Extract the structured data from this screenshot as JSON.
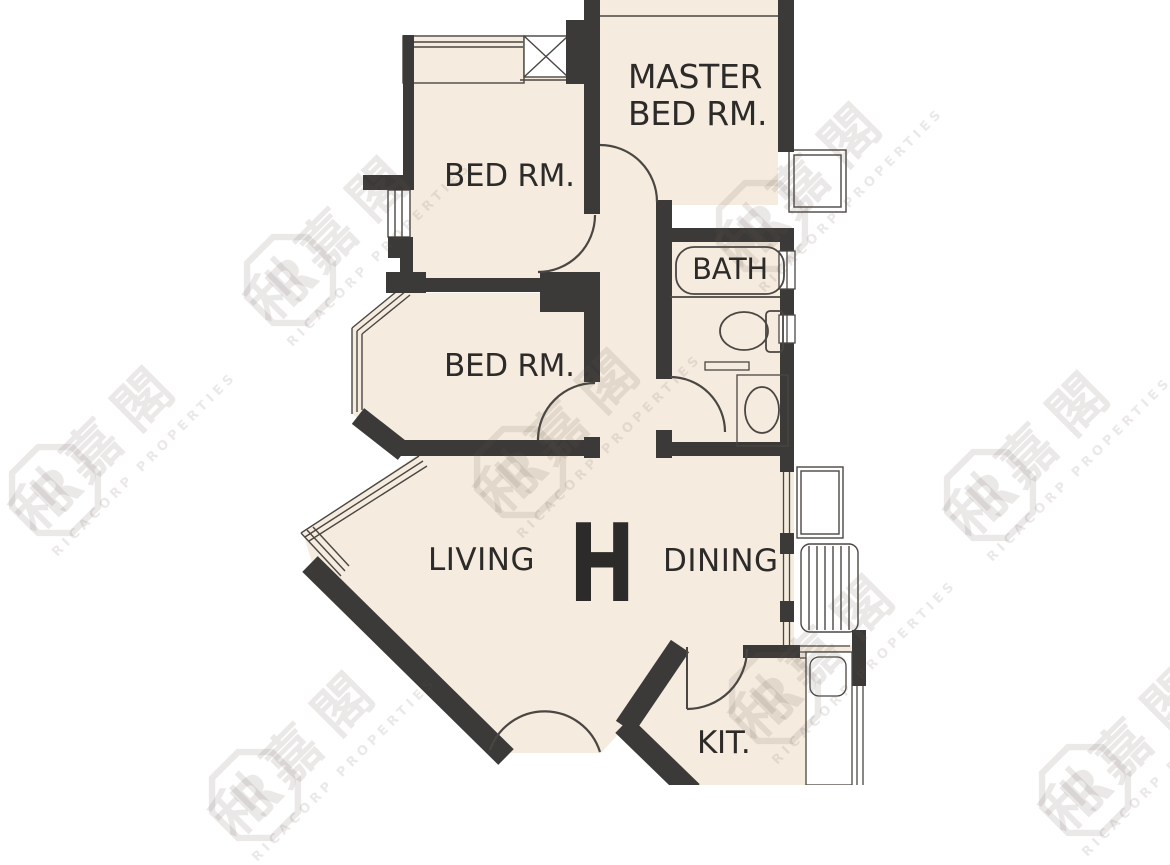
{
  "plan": {
    "unit_label": "H",
    "rooms": {
      "master_line1": "MASTER",
      "master_line2": "BED RM.",
      "bedroom_top": "BED RM.",
      "bedroom_mid": "BED RM.",
      "bath": "BATH",
      "living": "LIVING",
      "dining": "DINING",
      "kitchen": "KIT."
    }
  },
  "watermark": {
    "logo_letter": "R",
    "cjk": "利嘉閣",
    "latin": "RICACORP PROPERTIES"
  },
  "colors": {
    "wall": "#3b3a39",
    "floor": "#f5ecdf",
    "line": "#4a4642",
    "label": "#2d2b29",
    "background": "#ffffff",
    "watermark": "rgba(101,88,75,0.13)"
  }
}
